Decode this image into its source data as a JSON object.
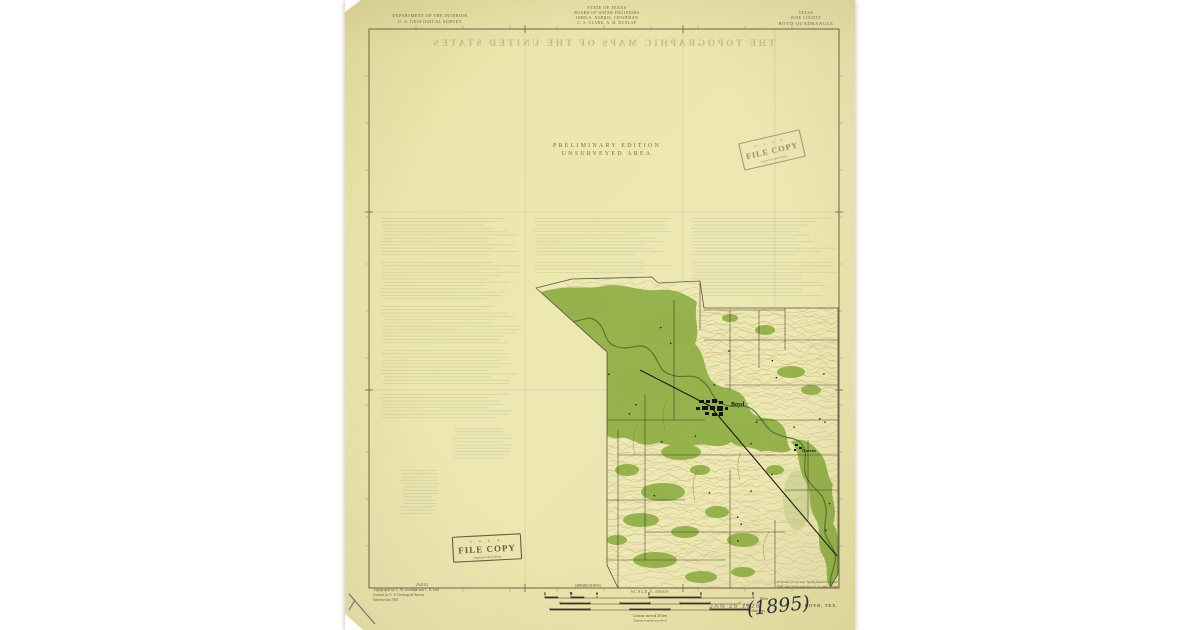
{
  "colors": {
    "paper": "#ede8b2",
    "map_paper": "#ede9b4",
    "forest_green": "#8fae45",
    "river_green": "#49702e",
    "contour_brown": "#c2935a",
    "ink_brown": "#5f5640",
    "neatline": "#5e553c"
  },
  "header": {
    "left1": "DEPARTMENT OF THE INTERIOR",
    "left2": "U. S. GEOLOGICAL SURVEY",
    "center1": "STATE OF TEXAS",
    "center2": "BOARD OF WATER ENGINEERS",
    "center3": "JOHN A. NORRIS, CHAIRMAN",
    "center4": "C. S. CLARK, A. H. DUNLAP",
    "right1": "TEXAS",
    "right2": "WISE COUNTY",
    "right3": "BOYD QUADRANGLE"
  },
  "map": {
    "preliminary1": "PRELIMINARY EDITION",
    "preliminary2": "UNSURVEYED AREA",
    "ghost_title": "THE TOPOGRAPHIC MAPS OF THE UNITED STATES",
    "town_label": "Boyd",
    "settlement_label": "Garvin"
  },
  "stamps": {
    "usgs": "U. S. G. S.",
    "file_copy": "FILE COPY",
    "stamp_sub": "Inspection and Editing",
    "date": "JAN 25 1926",
    "handwritten": "(1895)"
  },
  "footer": {
    "adjoining_left": "(AZLE)",
    "adjoining_center": "(SPRINGTOWN)",
    "credit1": "Topography by C. W. Goodhue and C. B. Hill",
    "credit2": "Control by U. S. Geological Survey",
    "credit3": "Surveyed in 1925",
    "scale_statement": "SCALE 1:48000",
    "miles_ticks": [
      "1",
      "½",
      "0",
      "1",
      "2",
      "3"
    ],
    "miles_unit": "Miles",
    "feet_unit": "Feet",
    "km_unit": "Kilometers",
    "contour_note": "Contour interval 20 feet",
    "datum_note": "Datum is mean sea level",
    "projection1": "Polyconic projection. North American datum",
    "projection2": "5000-yard grid based upon U. S. zone system",
    "sheet_name": "BOYD, TEX."
  }
}
